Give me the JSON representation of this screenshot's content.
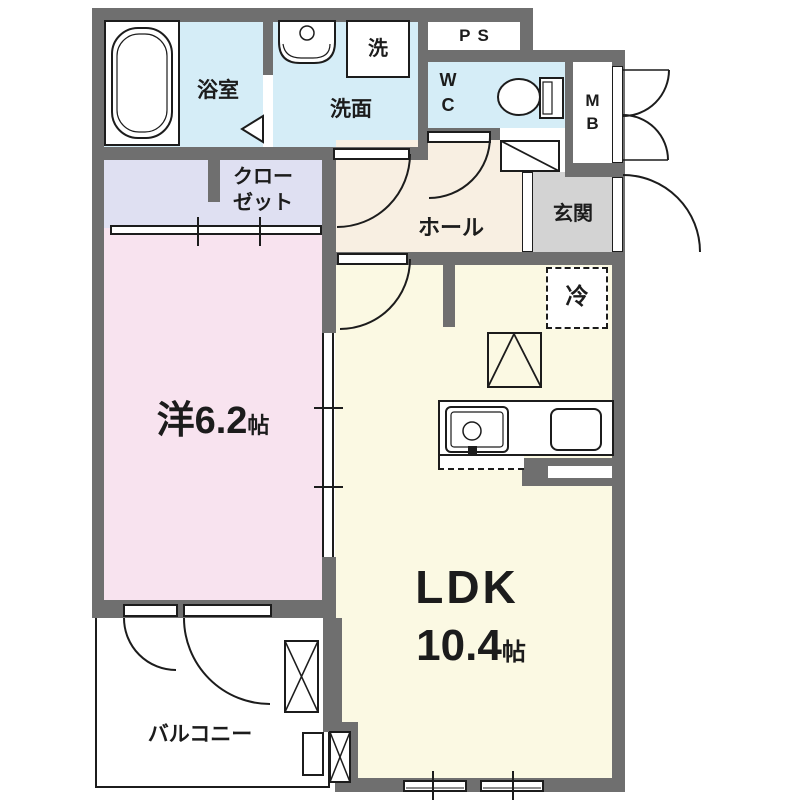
{
  "floorplan": {
    "title": "1LDK apartment floor plan",
    "rooms": {
      "bathroom": {
        "label": "浴室"
      },
      "washroom": {
        "label": "洗面"
      },
      "laundry": {
        "label": "洗"
      },
      "pipe_space": {
        "label": "PS"
      },
      "wc": {
        "line1": "W",
        "line2": "C"
      },
      "meter_box": {
        "line1": "M",
        "line2": "B"
      },
      "entrance": {
        "label": "玄関"
      },
      "hall": {
        "label": "ホール"
      },
      "closet": {
        "line1": "クロー",
        "line2": "ゼット"
      },
      "western_room": {
        "name": "洋6.2",
        "unit": "帖"
      },
      "ldk": {
        "name": "LDK",
        "size": "10.4",
        "unit": "帖"
      },
      "refrigerator": {
        "label": "冷"
      },
      "balcony": {
        "label": "バルコニー"
      }
    },
    "colors": {
      "wall": "#6f6f6f",
      "wet_area_blue": "#d5edf7",
      "closet_lavender": "#dfe0f2",
      "western_room_pink": "#f8e3ef",
      "hall_beige": "#f8efe2",
      "ldk_yellow": "#fbf9e3",
      "entrance_gray": "#d3d3d3",
      "line_black": "#1c1c1c"
    }
  }
}
